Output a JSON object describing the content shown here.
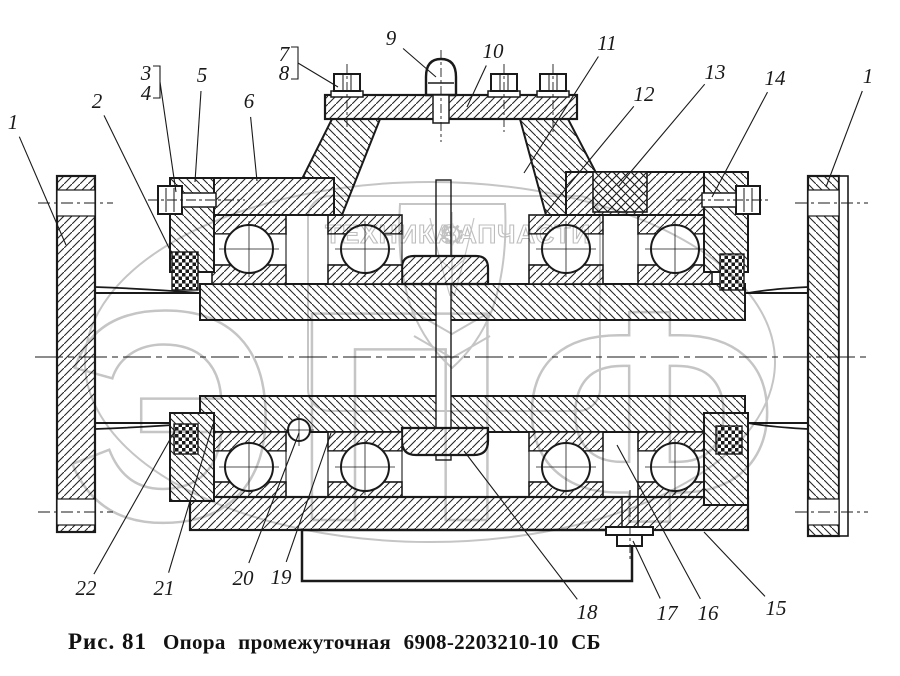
{
  "figure": {
    "caption_label": "Рис. 81",
    "caption_title": "Опора промежуточная 6908-2203210-10 СБ"
  },
  "watermark": {
    "letters": "ЭПФ",
    "left_text": "ТЕХНИКА",
    "right_text": "ЗАПЧАСТИ",
    "gear_icon": "⚙",
    "color": "#c5c5c5"
  },
  "drawing": {
    "ink": "#1a1a1a",
    "background": "#ffffff"
  },
  "callouts": [
    {
      "label": "1",
      "lx": 13,
      "ly": 122,
      "ex": 66,
      "ey": 245
    },
    {
      "label": "2",
      "lx": 97,
      "ly": 101,
      "ex": 172,
      "ey": 254
    },
    {
      "label": "3",
      "lx": 146,
      "ly": 73,
      "bracket": "b34"
    },
    {
      "label": "4",
      "lx": 146,
      "ly": 93,
      "bracket": "b34"
    },
    {
      "label": "5",
      "lx": 202,
      "ly": 75,
      "ex": 195,
      "ey": 182
    },
    {
      "label": "6",
      "lx": 249,
      "ly": 101,
      "ex": 257,
      "ey": 181
    },
    {
      "label": "7",
      "lx": 284,
      "ly": 54,
      "bracket": "b78"
    },
    {
      "label": "8",
      "lx": 284,
      "ly": 73,
      "bracket": "b78"
    },
    {
      "label": "9",
      "lx": 391,
      "ly": 38,
      "ex": 436,
      "ey": 77
    },
    {
      "label": "10",
      "lx": 493,
      "ly": 51,
      "ex": 467,
      "ey": 107
    },
    {
      "label": "11",
      "lx": 607,
      "ly": 43,
      "ex": 524,
      "ey": 173
    },
    {
      "label": "12",
      "lx": 644,
      "ly": 94,
      "ex": 545,
      "ey": 214
    },
    {
      "label": "13",
      "lx": 715,
      "ly": 72,
      "ex": 618,
      "ey": 187
    },
    {
      "label": "14",
      "lx": 775,
      "ly": 78,
      "ex": 712,
      "ey": 197
    },
    {
      "label": "1",
      "lx": 868,
      "ly": 76,
      "ex": 826,
      "ey": 187
    },
    {
      "label": "22",
      "lx": 86,
      "ly": 588,
      "ex": 177,
      "ey": 427
    },
    {
      "label": "21",
      "lx": 164,
      "ly": 588,
      "ex": 213,
      "ey": 424
    },
    {
      "label": "20",
      "lx": 243,
      "ly": 578,
      "ex": 299,
      "ey": 433
    },
    {
      "label": "19",
      "lx": 281,
      "ly": 577,
      "ex": 331,
      "ey": 433
    },
    {
      "label": "18",
      "lx": 587,
      "ly": 612,
      "ex": 464,
      "ey": 451
    },
    {
      "label": "17",
      "lx": 667,
      "ly": 613,
      "ex": 633,
      "ey": 541
    },
    {
      "label": "16",
      "lx": 708,
      "ly": 613,
      "ex": 617,
      "ey": 445
    },
    {
      "label": "15",
      "lx": 776,
      "ly": 608,
      "ex": 704,
      "ey": 532
    }
  ],
  "brackets": [
    {
      "id": "b34",
      "points": "153,66 160,66 160,98 153,98",
      "sx": 160,
      "sy": 82,
      "ex": 176,
      "ey": 192
    },
    {
      "id": "b78",
      "points": "291,47 298,47 298,79 291,79",
      "sx": 298,
      "sy": 63,
      "ex": 338,
      "ey": 87
    }
  ]
}
